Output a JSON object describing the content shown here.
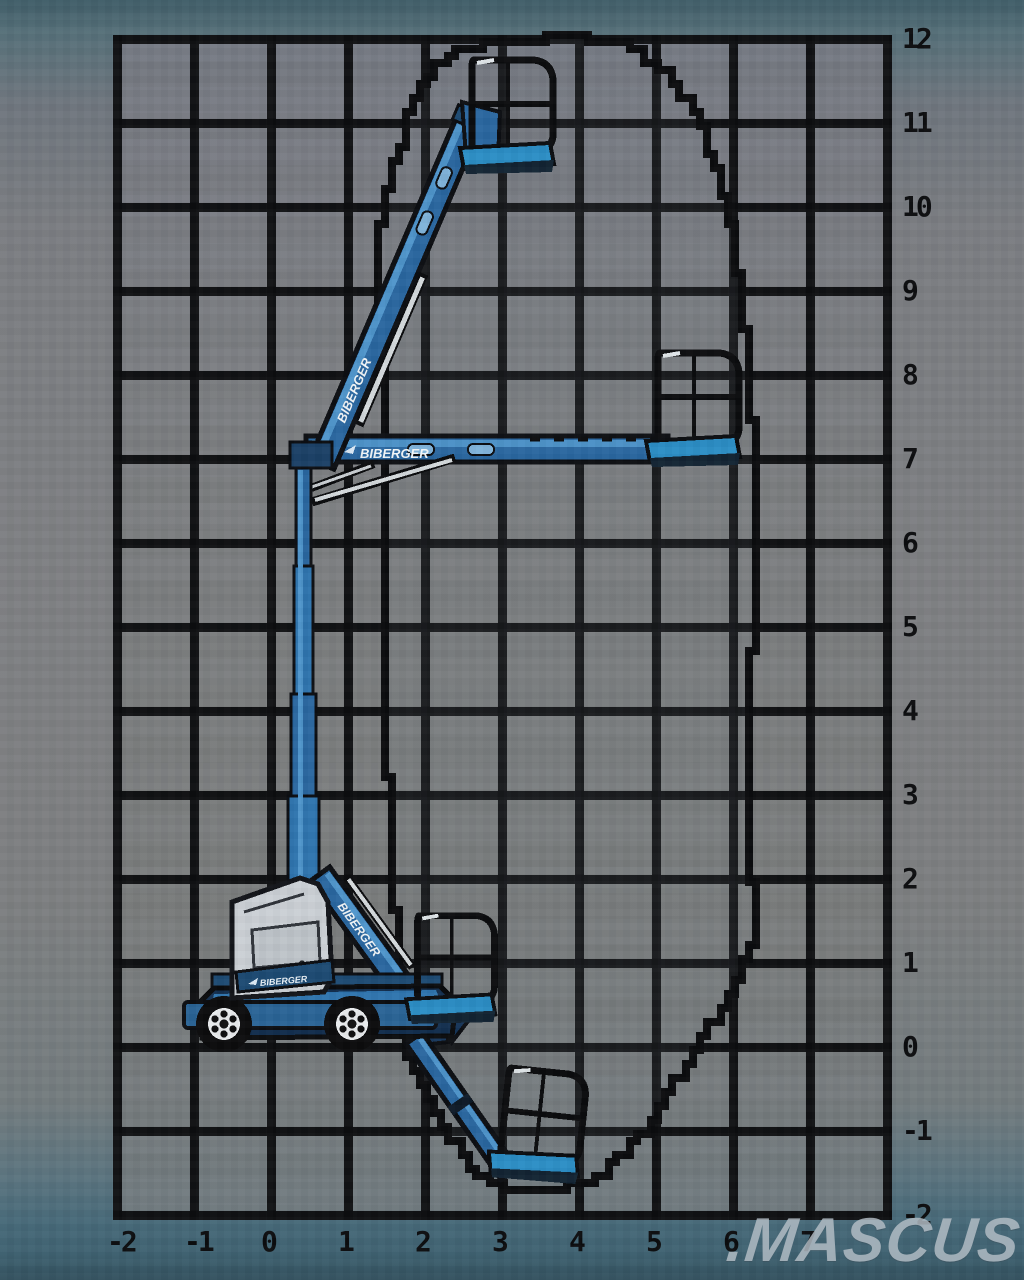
{
  "brand": {
    "logo_text": "BIBERGER"
  },
  "watermark": {
    "text": ".MASCUS"
  },
  "axes": {
    "right_labels": [
      "12",
      "11",
      "10",
      "9",
      "8",
      "7",
      "6",
      "5",
      "4",
      "3",
      "2",
      "1",
      "0",
      "-1",
      "-2"
    ],
    "bottom_labels": [
      "-2",
      "-1",
      "0",
      "1",
      "2",
      "3",
      "4",
      "5",
      "6",
      "7"
    ]
  },
  "machine": {
    "boom_upper_label": "BIBERGER",
    "boom_horizontal_label": "BIBERGER",
    "boom_jib_label": "BIBERGER",
    "body_label": "BIBERGER"
  },
  "colors": {
    "boom_blue": "#2a67a0",
    "boom_highlight": "#4f95cb",
    "basket_floor_blue": "#2c8ec5",
    "chassis_navy": "#133050",
    "skirt_blue": "#2a6496",
    "cowling_gray": "#cbd0d5",
    "grid_line": "#0c0d0f",
    "grid_bg": "#7d7f81",
    "outer_teal_top": "#46646f",
    "outer_teal_bottom": "#3e6170",
    "watermark_gray": "#b5bfc7"
  },
  "envelope": {
    "points_px": [
      [
        452,
        48
      ],
      [
        500,
        40
      ],
      [
        560,
        38
      ],
      [
        618,
        44
      ],
      [
        660,
        68
      ],
      [
        698,
        128
      ],
      [
        726,
        210
      ],
      [
        744,
        300
      ],
      [
        752,
        390
      ],
      [
        755,
        480
      ],
      [
        753,
        600
      ],
      [
        751,
        720
      ],
      [
        751,
        840
      ],
      [
        756,
        948
      ],
      [
        735,
        992
      ],
      [
        700,
        1052
      ],
      [
        658,
        1118
      ],
      [
        612,
        1178
      ],
      [
        570,
        1192
      ],
      [
        520,
        1192
      ],
      [
        478,
        1168
      ],
      [
        440,
        1114
      ],
      [
        404,
        1044
      ],
      [
        396,
        960
      ],
      [
        390,
        840
      ],
      [
        388,
        700
      ],
      [
        388,
        560
      ],
      [
        387,
        460
      ],
      [
        384,
        340
      ],
      [
        381,
        240
      ],
      [
        390,
        160
      ],
      [
        412,
        100
      ],
      [
        436,
        64
      ],
      [
        452,
        48
      ]
    ],
    "approx_range_m": {
      "height_min": -1.7,
      "height_max": 12,
      "outreach_max": 6.2,
      "tail_min": -2
    }
  }
}
